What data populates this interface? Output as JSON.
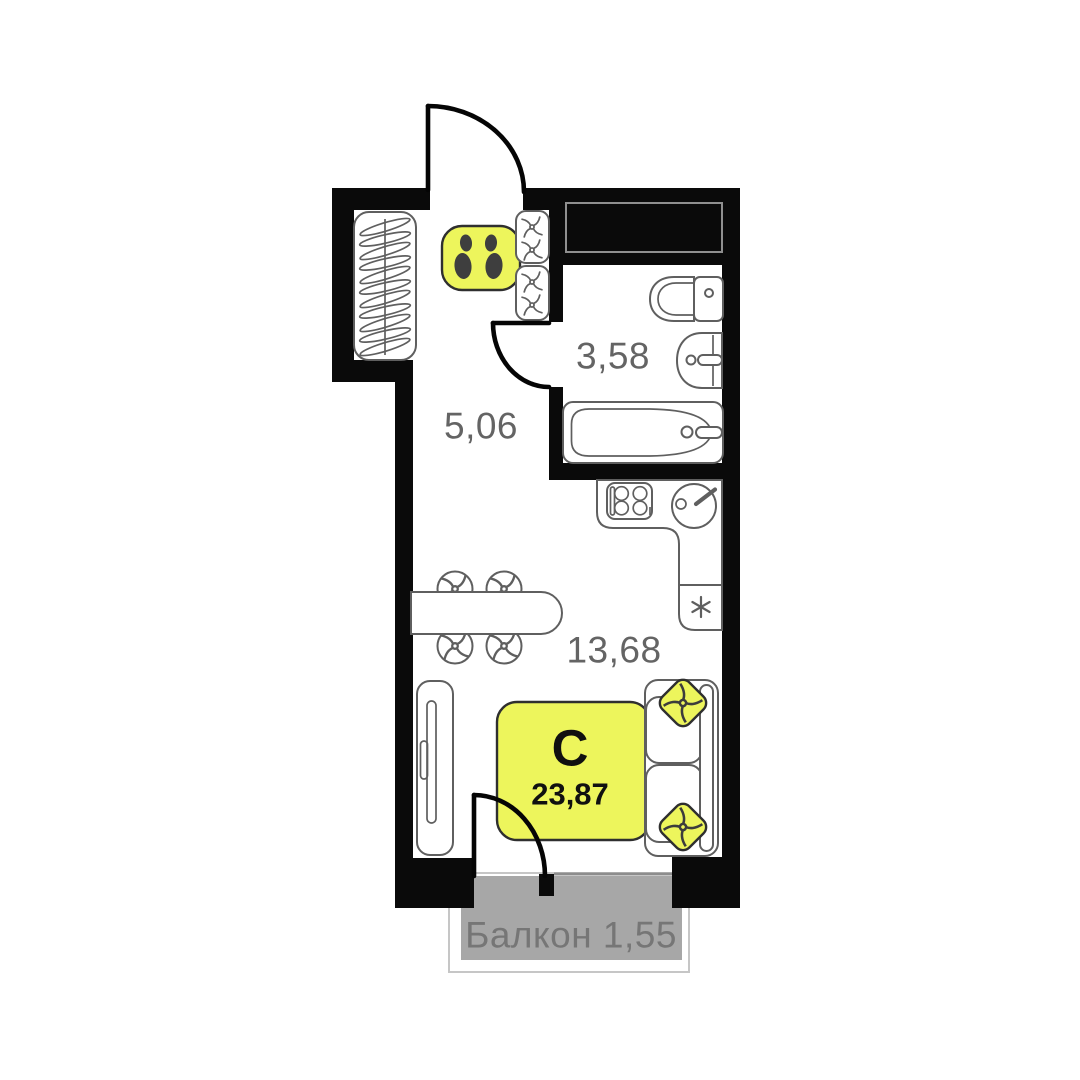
{
  "plan": {
    "unit": {
      "type_letter": "С",
      "total_area": "23,87"
    },
    "rooms": [
      {
        "name": "hallway",
        "area": "5,06"
      },
      {
        "name": "bathroom",
        "area": "3,58"
      },
      {
        "name": "living-kitchen",
        "area": "13,68"
      }
    ],
    "balcony": {
      "name": "Балкон",
      "area": "1,55"
    }
  },
  "colors": {
    "accent_yellow": "#EDF55C",
    "wall_black": "#0A0A0A",
    "outline_gray": "#5F5F5F",
    "label_gray": "#646464",
    "balcony_fill": "#A7A7A7",
    "balcony_text": "#767676",
    "shoe_print": "#3E3E3E"
  },
  "icons": {
    "entry-door-icon": "quarter-circle swing arc",
    "bathroom-door-icon": "quarter-circle swing arc",
    "balcony-door-icon": "quarter-circle swing arc",
    "hanger-rack-icon": "rail with coat hangers",
    "shoe-mat-icon": "two footprints on mat",
    "shelf-unit-icon": "rounded box with pinwheel towels",
    "vent-shaft-icon": "solid black duct block",
    "toilet-icon": "bowl with cistern",
    "washbasin-icon": "half-round sink with tap",
    "bathtub-icon": "tub with tap",
    "stove-icon": "4-burner hob",
    "kitchen-sink-icon": "round bowl with lever tap",
    "fridge-icon": "asterisk compartment",
    "dining-table-icon": "capsule table with 4 round chairs",
    "wardrobe-icon": "cabinet with handle",
    "bed-icon": "yellow highlighted bed",
    "sofa-icon": "two-seat sofa",
    "pillow-icon": "yellow diamond cushion with swirl"
  }
}
